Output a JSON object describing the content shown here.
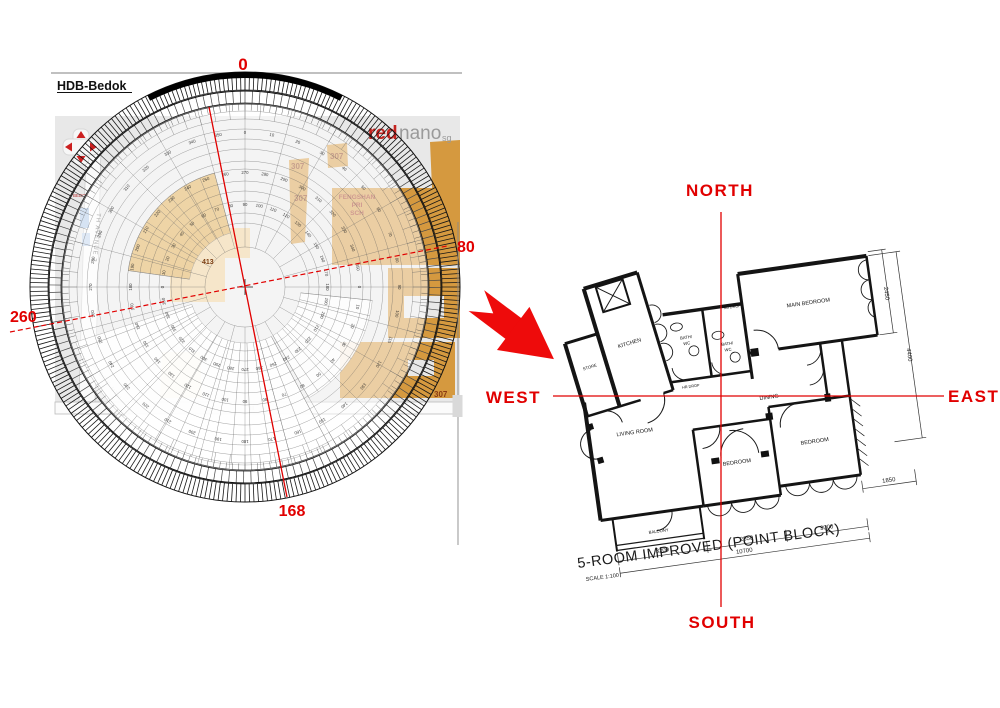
{
  "map": {
    "title": "HDB-Bedok",
    "logo": {
      "part1": "red",
      "part2": "nano",
      "part3": "sg"
    },
    "bearings": {
      "top": "0",
      "right": "80",
      "bottom": "168",
      "left": "260"
    },
    "school": {
      "line1": "FENGSHAN",
      "line2": "PRI",
      "line3": "SCH"
    },
    "blocks": {
      "b1": "307",
      "b2": "307",
      "b3": "307",
      "b4": "307",
      "center": "413"
    },
    "streets": {
      "vertical": "TH AVENUE 2",
      "diagonal": "BEDOK NTH",
      "red_small": "BEDOK",
      "road_mark": "III"
    },
    "colors": {
      "background": "#e8e8e8",
      "building": "#d5993f",
      "building_light": "#eccb90",
      "road": "#fbfbfb",
      "block_label": "#8a3a12",
      "red": "#e10000"
    }
  },
  "compass": {
    "center": {
      "x": 245,
      "y": 287
    },
    "degree_step": 10,
    "number_rings": [
      {
        "r": 153,
        "offset": 0
      },
      {
        "r": 113,
        "offset": 270
      },
      {
        "r": 81,
        "offset": 90
      }
    ],
    "circles": [
      40,
      64,
      74,
      86,
      96,
      106,
      118,
      126,
      138,
      148,
      158,
      168,
      176,
      183
    ],
    "spoke_step": 15,
    "hatch": [
      {
        "r1": 197,
        "r2": 215,
        "step": 1.2,
        "color": "#161616",
        "w": 0.8
      },
      {
        "r1": 184,
        "r2": 196,
        "step": 2.2,
        "color": "#474747",
        "w": 0.7
      }
    ],
    "fans": [
      {
        "a1": 152,
        "a2": 252,
        "r1": 56,
        "r2": 178,
        "fill": "#ffffff",
        "opacity": 0.92,
        "step": 6.5
      },
      {
        "a1": 96,
        "a2": 150,
        "r1": 56,
        "r2": 128,
        "fill": "#ffffff",
        "opacity": 0.85,
        "step": 7
      },
      {
        "a1": 278,
        "a2": 345,
        "r1": 56,
        "r2": 118,
        "fill": "#eed3a2",
        "opacity": 0.95,
        "step": 8.5
      }
    ]
  },
  "arrow": {
    "color": "#ee0b0b"
  },
  "directions": {
    "north": "NORTH",
    "south": "SOUTH",
    "east": "EAST",
    "west": "WEST"
  },
  "floorplan": {
    "rooms": {
      "kitchen": "KITCHEN",
      "store": "STORE",
      "bath1_line1": "BATH/",
      "bath1_line2": "WC",
      "bath2_line1": "BATH/",
      "bath2_line2": "WC",
      "main_bedroom": "MAIN BEDROOM",
      "dining": "DINING",
      "living": "LIVING ROOM",
      "bedroom1": "BEDROOM",
      "bedroom2": "BEDROOM",
      "balcony": "BALCONY",
      "rb_drop": "RB DROP",
      "hr_drop": "HR DROP"
    },
    "dims": {
      "d2450": "2450",
      "d4400": "4400",
      "d1850": "1850",
      "d3200": "3200",
      "d2850": "2850",
      "d3000": "3000",
      "d10700": "10700"
    },
    "title": "5-ROOM IMPROVED (POINT BLOCK)",
    "scale": "SCALE 1:100"
  }
}
